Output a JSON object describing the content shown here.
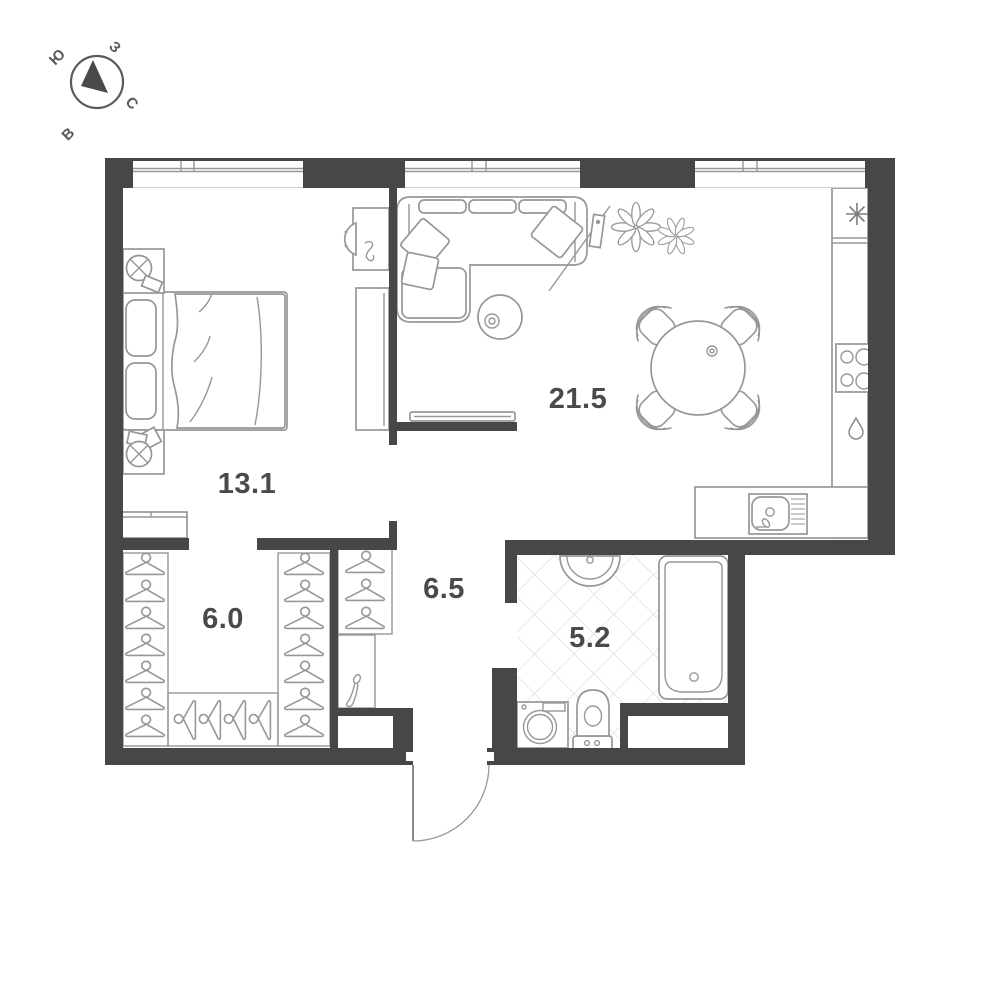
{
  "title": "apartment-floor-plan",
  "compass": {
    "south": "Ю",
    "west": "З",
    "north": "С",
    "east": "В"
  },
  "rooms": {
    "bedroom": {
      "area": "13.1"
    },
    "living_kitchen": {
      "area": "21.5"
    },
    "wardrobe": {
      "area": "6.0"
    },
    "hallway": {
      "area": "6.5"
    },
    "bathroom": {
      "area": "5.2"
    }
  },
  "colors": {
    "wall": "#474747",
    "furniture_line": "#979797",
    "label_text": "#4a4a4a",
    "tile_line": "#dddddd",
    "background": "#ffffff"
  }
}
